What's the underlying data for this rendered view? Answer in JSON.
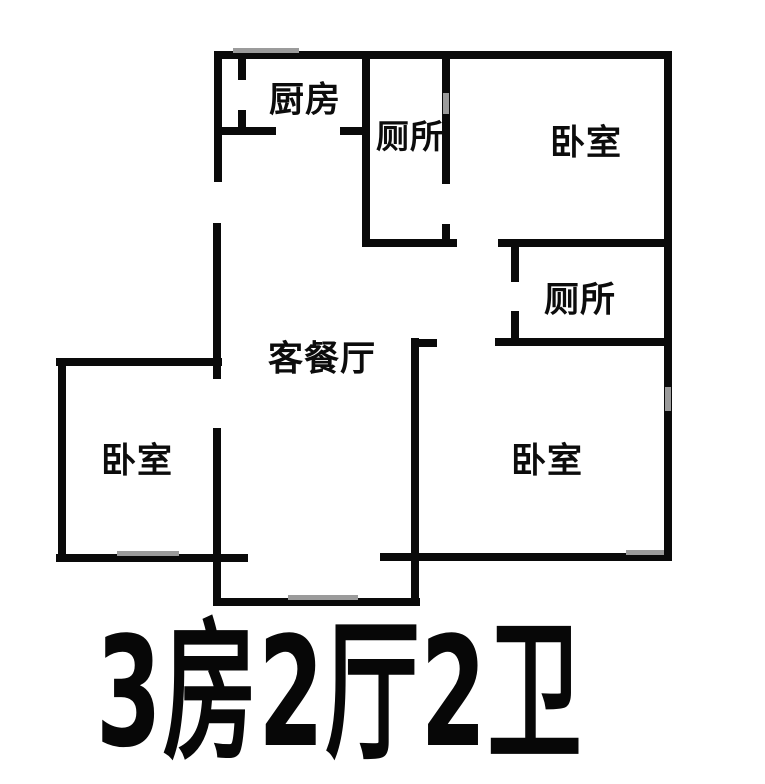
{
  "caption": {
    "text": "3房2厅2卫"
  },
  "rooms": {
    "kitchen": {
      "label": "厨房"
    },
    "toilet_upper": {
      "label": "厕所"
    },
    "bedroom_upper_right": {
      "label": "卧室"
    },
    "toilet_right": {
      "label": "厕所"
    },
    "living_dining": {
      "label": "客餐厅"
    },
    "bedroom_left": {
      "label": "卧室"
    },
    "bedroom_lower_right": {
      "label": "卧室"
    }
  },
  "colors": {
    "wall": "#0a0a0a",
    "window": "#9b9b9b",
    "background": "#ffffff"
  }
}
